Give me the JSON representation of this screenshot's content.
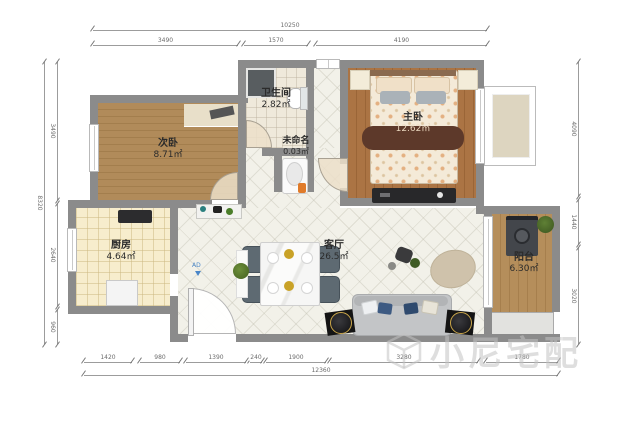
{
  "rooms": [
    {
      "id": "bedroom2",
      "name": "次卧",
      "area": "8.71㎡"
    },
    {
      "id": "bathroom",
      "name": "卫生间",
      "area": "2.82㎡"
    },
    {
      "id": "unnamed",
      "name": "未命名",
      "area": "0.03㎡"
    },
    {
      "id": "master_bedroom",
      "name": "主卧",
      "area": "12.62㎡"
    },
    {
      "id": "kitchen",
      "name": "厨房",
      "area": "4.64㎡"
    },
    {
      "id": "living_room",
      "name": "客厅",
      "area": "26.5㎡"
    },
    {
      "id": "balcony",
      "name": "阳台",
      "area": "6.30㎡"
    }
  ],
  "markers": {
    "ad_label": "AD"
  },
  "watermark": {
    "text": "小尼宅配"
  },
  "dimensions": {
    "top_total": "10250",
    "top_segments": [
      "3490",
      "1570",
      "4190"
    ],
    "bottom_segments": [
      "1420",
      "980",
      "1390",
      "240",
      "1900",
      "3280",
      "1780"
    ],
    "bottom_total": "12360",
    "left_total": "8320",
    "left_segments": [
      "3490",
      "2640",
      "960"
    ],
    "right_segments": [
      "4090",
      "1440",
      "3020"
    ]
  },
  "colors": {
    "wall": "#8b8b8b",
    "wood_light": "#b18b5a",
    "wood_red": "#ab7444",
    "tile_living": "#f2f1e9",
    "tile_kitchen": "#f7edcd",
    "runner_band": "#5d392a",
    "sofa": "#c3c5c7",
    "chair": "#5e6a72",
    "accent_orange": "#e07b2a",
    "ad_blue": "#4a86c8"
  }
}
